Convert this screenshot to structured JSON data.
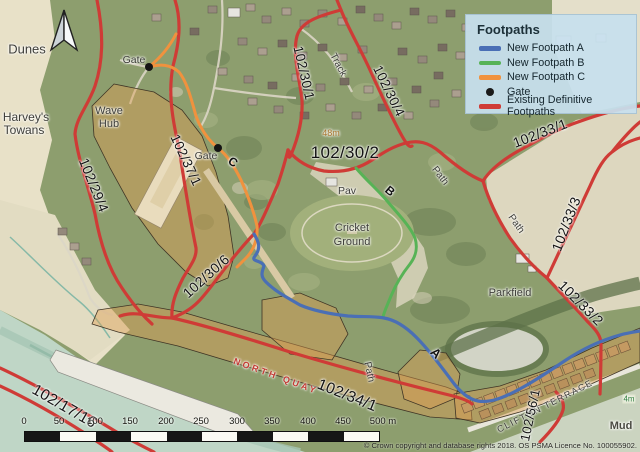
{
  "legend": {
    "title": "Footpaths",
    "items": [
      {
        "label": "New Footpath A",
        "color": "#4a6fb5",
        "type": "line"
      },
      {
        "label": "New Footpath B",
        "color": "#57b356",
        "type": "line"
      },
      {
        "label": "New Footpath C",
        "color": "#f0923e",
        "type": "line"
      },
      {
        "label": "Gate",
        "color": "#1a1a1a",
        "type": "dot"
      },
      {
        "label": "Existing Definitive Footpaths",
        "color": "#cf3b36",
        "type": "line"
      }
    ]
  },
  "map_labels": {
    "dunes": "Dunes",
    "harveys_line1": "Harvey's",
    "harveys_line2": "Towans",
    "wave_hub_line1": "Wave",
    "wave_hub_line2": "Hub",
    "gate1": "Gate",
    "gate2": "Gate",
    "letter_a": "A",
    "letter_b": "B",
    "letter_c": "C",
    "track": "Track",
    "path_northeast": "Path",
    "path_parkfield": "Path",
    "path_quay": "Path",
    "pav": "Pav",
    "cricket_line1": "Cricket",
    "cricket_line2": "Ground",
    "parkfield": "Parkfield",
    "mud": "Mud",
    "north_quay": "NORTH QUAY",
    "clifton_terrace": "CLIFTON TERRACE",
    "spot_height_48": "48m",
    "spot_height_4": "4m"
  },
  "footpath_numbers": {
    "p_102_29_4": "102/29/4",
    "p_102_37_1": "102/37/1",
    "p_102_30_1": "102/30/1",
    "p_102_30_4": "102/30/4",
    "p_102_30_2": "102/30/2",
    "p_102_30_6": "102/30/6",
    "p_102_33_1": "102/33/1",
    "p_102_33_3": "102/33/3",
    "p_102_33_2": "102/33/2",
    "p_102_34_1": "102/34/1",
    "p_102_17_16": "102/17/16",
    "p_102_56_1": "102/56/1"
  },
  "scale_bar": {
    "ticks": [
      "0",
      "50",
      "100",
      "150",
      "200",
      "250",
      "300",
      "350",
      "400",
      "450"
    ],
    "end_label": "500 m"
  },
  "attribution": "© Crown copyright and database rights 2018. OS PSMA Licence No. 100055902."
}
